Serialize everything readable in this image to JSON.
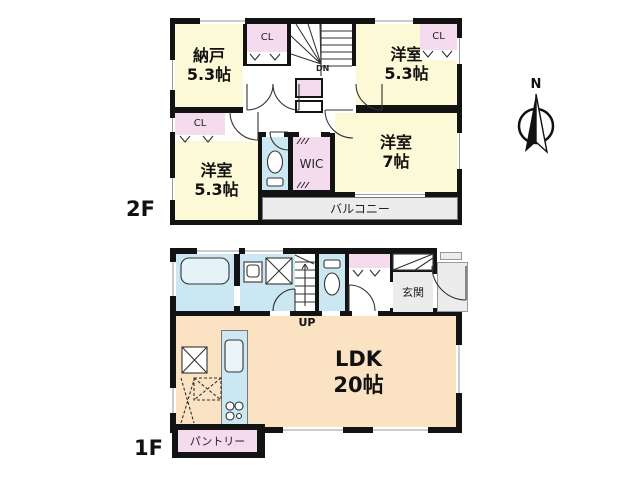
{
  "colors": {
    "wall": "#131313",
    "bedroom_fill": "#FBF9D6",
    "closet_fill": "#F4DCEE",
    "sanitary_fill": "#CBE7F2",
    "ldk_fill": "#FAE2C3",
    "outdoor_fill": "#ECECEC"
  },
  "compass": {
    "north_label": "N"
  },
  "floor2": {
    "floor_label": "2F",
    "stairs_label": "DN",
    "balcony_label": "バルコニー",
    "wic_label": "WIC",
    "nando": {
      "name": "納戸",
      "area": "5.3帖"
    },
    "nando_closet_label": "CL",
    "bedroom_ne": {
      "name": "洋室",
      "area": "5.3帖"
    },
    "bedroom_ne_closet_label": "CL",
    "bedroom_e": {
      "name": "洋室",
      "area": "7帖"
    },
    "bedroom_sw": {
      "name": "洋室",
      "area": "5.3帖"
    },
    "bedroom_sw_closet_label": "CL"
  },
  "floor1": {
    "floor_label": "1F",
    "stairs_label": "UP",
    "entrance_label": "玄関",
    "pantry_label": "パントリー",
    "ldk": {
      "name": "LDK",
      "area": "20帖"
    }
  }
}
